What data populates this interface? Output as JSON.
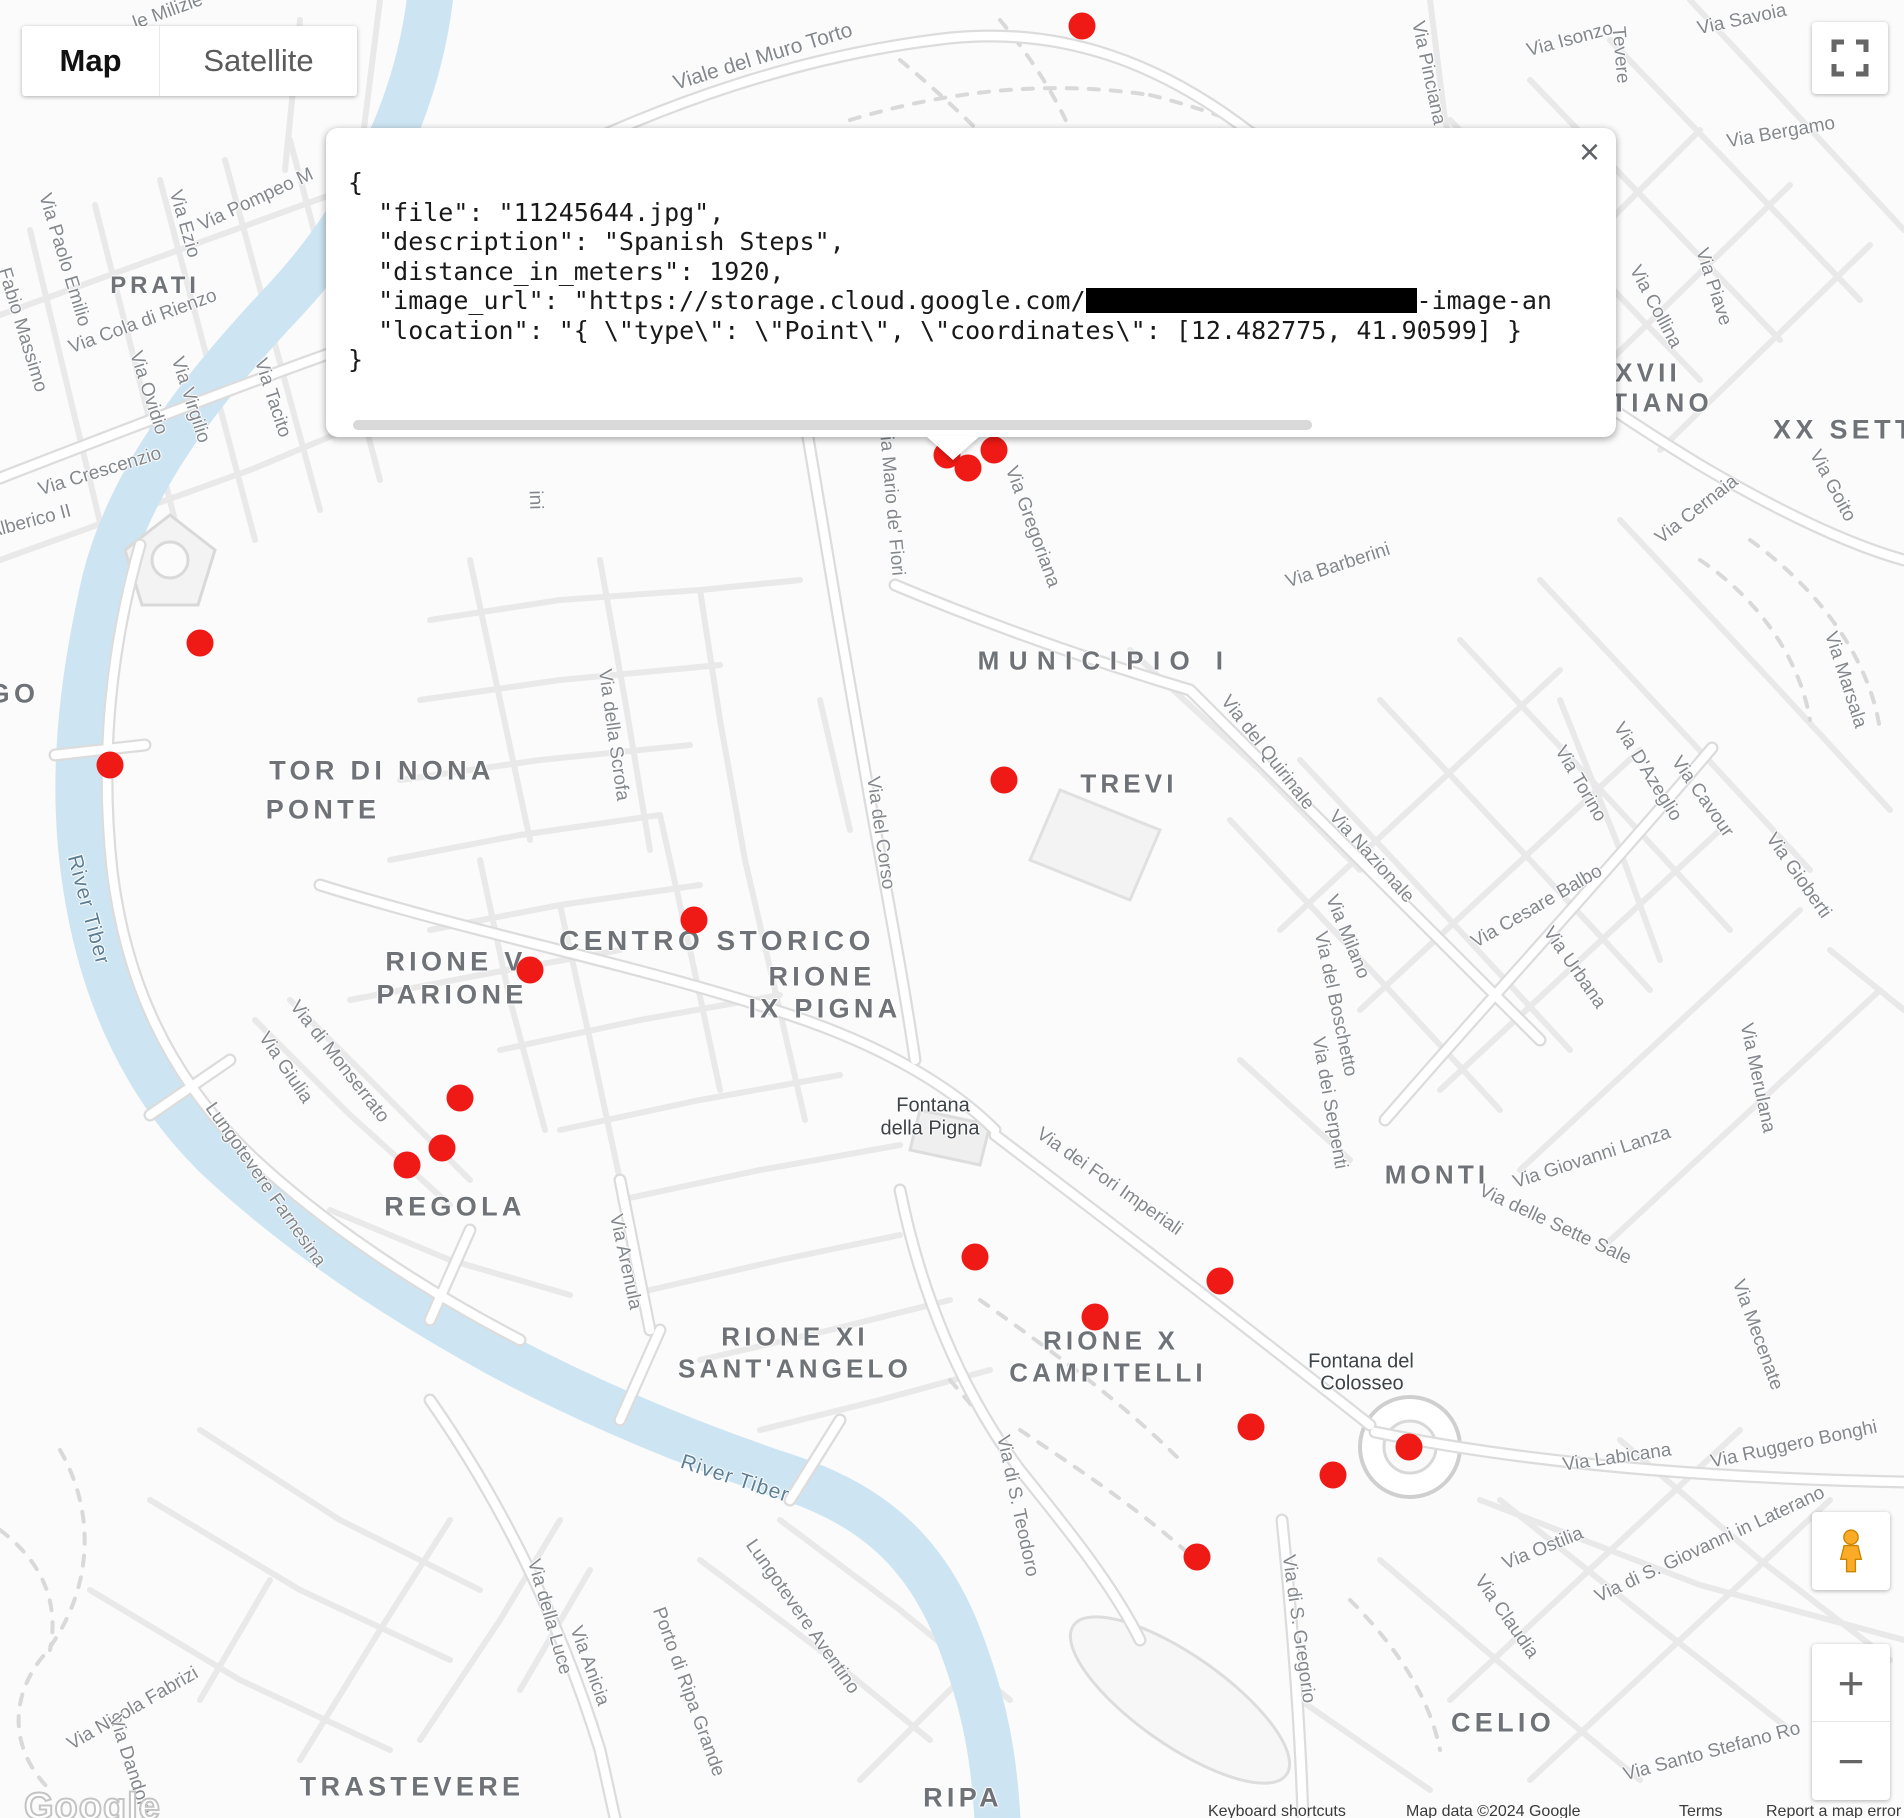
{
  "map_type_control": {
    "map": "Map",
    "satellite": "Satellite"
  },
  "info_window": {
    "close": "×",
    "lines": [
      {
        "text": "{"
      },
      {
        "text": "  \"file\": \"11245644.jpg\","
      },
      {
        "text": "  \"description\": \"Spanish Steps\","
      },
      {
        "text": "  \"distance_in_meters\": 1920,"
      },
      {
        "pre": "  \"image_url\": \"https://storage.cloud.google.com/",
        "redacted_width": 331,
        "post": "-image-an"
      },
      {
        "text": "  \"location\": \"{ \\\"type\\\": \\\"Point\\\", \\\"coordinates\\\": [12.482775, 41.90599] }"
      },
      {
        "text": "}"
      }
    ]
  },
  "marker_color": "#ef1a16",
  "markers": [
    [
      1082,
      26
    ],
    [
      947,
      455
    ],
    [
      968,
      468
    ],
    [
      994,
      450
    ],
    [
      200,
      643
    ],
    [
      110,
      765
    ],
    [
      1004,
      780
    ],
    [
      694,
      920
    ],
    [
      530,
      970
    ],
    [
      460,
      1098
    ],
    [
      442,
      1148
    ],
    [
      407,
      1165
    ],
    [
      975,
      1257
    ],
    [
      1220,
      1281
    ],
    [
      1095,
      1317
    ],
    [
      1251,
      1427
    ],
    [
      1409,
      1447
    ],
    [
      1333,
      1475
    ],
    [
      1197,
      1557
    ]
  ],
  "labels": {
    "area": [
      {
        "t": "PRATI",
        "x": 155,
        "y": 286,
        "s": 24
      },
      {
        "t": "GO",
        "x": 14,
        "y": 694
      },
      {
        "t": "TOR DI NONA",
        "x": 382,
        "y": 771
      },
      {
        "t": "PONTE",
        "x": 323,
        "y": 810
      },
      {
        "t": "MUNICIPIO I",
        "x": 1105,
        "y": 661,
        "s": 26,
        "ls": 0.36
      },
      {
        "t": "TREVI",
        "x": 1129,
        "y": 784,
        "s": 26
      },
      {
        "t": "CENTRO STORICO",
        "x": 717,
        "y": 941,
        "s": 28
      },
      {
        "t": "RIONE V",
        "x": 456,
        "y": 962
      },
      {
        "t": "PARIONE",
        "x": 452,
        "y": 995
      },
      {
        "t": "RIONE",
        "x": 822,
        "y": 977
      },
      {
        "t": "IX PIGNA",
        "x": 825,
        "y": 1009
      },
      {
        "t": "REGOLA",
        "x": 455,
        "y": 1207
      },
      {
        "t": "MONTI",
        "x": 1437,
        "y": 1175,
        "s": 26
      },
      {
        "t": "RIONE XI",
        "x": 795,
        "y": 1337,
        "s": 26
      },
      {
        "t": "SANT'ANGELO",
        "x": 795,
        "y": 1369,
        "s": 26
      },
      {
        "t": "RIONE X",
        "x": 1111,
        "y": 1341,
        "s": 26
      },
      {
        "t": "CAMPITELLI",
        "x": 1108,
        "y": 1373,
        "s": 26
      },
      {
        "t": "CELIO",
        "x": 1503,
        "y": 1723
      },
      {
        "t": "TRASTEVERE",
        "x": 412,
        "y": 1787
      },
      {
        "t": "RIPA",
        "x": 963,
        "y": 1798
      },
      {
        "t": "XVII",
        "x": 1648,
        "y": 373,
        "s": 26
      },
      {
        "t": "TIANO",
        "x": 1662,
        "y": 403,
        "s": 26
      },
      {
        "t": "XX SETTEMBRE",
        "x": 1773,
        "y": 430,
        "anchor": "left"
      }
    ],
    "street": [
      {
        "t": "le Milizie",
        "x": 168,
        "y": 12,
        "r": -20
      },
      {
        "t": "Viale del Muro Torto",
        "x": 763,
        "y": 57,
        "r": -17,
        "s": 21
      },
      {
        "t": "Via Pinciana",
        "x": 1428,
        "y": 73,
        "r": 78
      },
      {
        "t": "Via Isonzo",
        "x": 1570,
        "y": 40,
        "r": -15
      },
      {
        "t": "Tevere",
        "x": 1620,
        "y": 55,
        "r": 85
      },
      {
        "t": "Via Savoia",
        "x": 1742,
        "y": 20,
        "r": -12
      },
      {
        "t": "Via Bergamo",
        "x": 1781,
        "y": 133,
        "r": -10
      },
      {
        "t": "Via Piave",
        "x": 1713,
        "y": 287,
        "r": 72
      },
      {
        "t": "Via Collina",
        "x": 1655,
        "y": 307,
        "r": 62
      },
      {
        "t": "Via Goito",
        "x": 1832,
        "y": 486,
        "r": 62
      },
      {
        "t": "Via Cernaia",
        "x": 1697,
        "y": 510,
        "r": -38
      },
      {
        "t": "Via Marsala",
        "x": 1845,
        "y": 680,
        "r": 72
      },
      {
        "t": "Via Pompeo M",
        "x": 256,
        "y": 200,
        "r": -25
      },
      {
        "t": "Via Ezio",
        "x": 184,
        "y": 224,
        "r": 74
      },
      {
        "t": "Via Paolo Emilio",
        "x": 64,
        "y": 260,
        "r": 73
      },
      {
        "t": "Fabio Massimo",
        "x": 22,
        "y": 330,
        "r": 73
      },
      {
        "t": "Via Cola di Rienzo",
        "x": 143,
        "y": 322,
        "r": -20
      },
      {
        "t": "Via Ovidio",
        "x": 148,
        "y": 393,
        "r": 72
      },
      {
        "t": "Via Virgilio",
        "x": 190,
        "y": 400,
        "r": 72
      },
      {
        "t": "Via Tacito",
        "x": 272,
        "y": 398,
        "r": 72
      },
      {
        "t": "Via Crescenzio",
        "x": 100,
        "y": 472,
        "r": -17
      },
      {
        "t": "Alberico II",
        "x": 30,
        "y": 522,
        "r": -15
      },
      {
        "t": "ini",
        "x": 535,
        "y": 500,
        "r": 88
      },
      {
        "t": "Via della Scrofa",
        "x": 613,
        "y": 735,
        "r": 82
      },
      {
        "t": "Via del Corso",
        "x": 880,
        "y": 833,
        "r": 82
      },
      {
        "t": "Via Mario de' Fiori",
        "x": 891,
        "y": 500,
        "r": 85
      },
      {
        "t": "Via Gregoriana",
        "x": 1032,
        "y": 527,
        "r": 70
      },
      {
        "t": "Via Barberini",
        "x": 1338,
        "y": 566,
        "r": -18
      },
      {
        "t": "Via del Quirinale",
        "x": 1267,
        "y": 753,
        "r": 52
      },
      {
        "t": "Via Nazionale",
        "x": 1371,
        "y": 857,
        "r": 48
      },
      {
        "t": "Via Milano",
        "x": 1347,
        "y": 937,
        "r": 68
      },
      {
        "t": "Via del Boschetto",
        "x": 1335,
        "y": 1004,
        "r": 78
      },
      {
        "t": "Via dei Serpenti",
        "x": 1329,
        "y": 1103,
        "r": 80
      },
      {
        "t": "Via Torino",
        "x": 1580,
        "y": 784,
        "r": 60
      },
      {
        "t": "Via D'Azeglio",
        "x": 1647,
        "y": 772,
        "r": 58
      },
      {
        "t": "Via Cavour",
        "x": 1702,
        "y": 797,
        "r": 55
      },
      {
        "t": "Via Gioberti",
        "x": 1798,
        "y": 876,
        "r": 55
      },
      {
        "t": "Via Cesare Balbo",
        "x": 1537,
        "y": 907,
        "r": -30
      },
      {
        "t": "Via Urbana",
        "x": 1574,
        "y": 968,
        "r": 55
      },
      {
        "t": "Via Giovanni Lanza",
        "x": 1592,
        "y": 1158,
        "r": -18
      },
      {
        "t": "Via delle Sette Sale",
        "x": 1555,
        "y": 1225,
        "r": 25
      },
      {
        "t": "Via Merulana",
        "x": 1757,
        "y": 1078,
        "r": 78
      },
      {
        "t": "Via Mecenate",
        "x": 1757,
        "y": 1335,
        "r": 70
      },
      {
        "t": "Via Ruggero Bonghi",
        "x": 1794,
        "y": 1445,
        "r": -12
      },
      {
        "t": "Via Labicana",
        "x": 1617,
        "y": 1458,
        "r": -8
      },
      {
        "t": "Via di S. Giovanni in Laterano",
        "x": 1710,
        "y": 1545,
        "r": -25
      },
      {
        "t": "Via Ostilia",
        "x": 1543,
        "y": 1549,
        "r": -22
      },
      {
        "t": "Via Claudia",
        "x": 1506,
        "y": 1617,
        "r": 55
      },
      {
        "t": "Via Santo Stefano Ro",
        "x": 1712,
        "y": 1752,
        "r": -15
      },
      {
        "t": "Via di S. Gregorio",
        "x": 1298,
        "y": 1629,
        "r": 82
      },
      {
        "t": "Via di S. Teodoro",
        "x": 1017,
        "y": 1506,
        "r": 78
      },
      {
        "t": "Via dei Fori Imperiali",
        "x": 1109,
        "y": 1182,
        "r": 35
      },
      {
        "t": "Via Arenula",
        "x": 625,
        "y": 1262,
        "r": 78
      },
      {
        "t": "Via di Monserrato",
        "x": 339,
        "y": 1062,
        "r": 52
      },
      {
        "t": "Via Giulia",
        "x": 285,
        "y": 1068,
        "r": 56
      },
      {
        "t": "Lungotevere Farnesina",
        "x": 265,
        "y": 1185,
        "r": 55
      },
      {
        "t": "Via della Luce",
        "x": 549,
        "y": 1617,
        "r": 74
      },
      {
        "t": "Via Anicia",
        "x": 589,
        "y": 1666,
        "r": 70
      },
      {
        "t": "Via Nicola Fabrizi",
        "x": 133,
        "y": 1709,
        "r": -30
      },
      {
        "t": "Via Dandolo",
        "x": 130,
        "y": 1765,
        "r": 72
      },
      {
        "t": "Porto di Ripa Grande",
        "x": 688,
        "y": 1692,
        "r": 70
      },
      {
        "t": "Lungotevere Aventino",
        "x": 802,
        "y": 1617,
        "r": 55
      }
    ],
    "poi": [
      {
        "t": "Fontana",
        "x": 933,
        "y": 1106
      },
      {
        "t": "della Pigna",
        "x": 930,
        "y": 1129
      },
      {
        "t": "Fontana del",
        "x": 1361,
        "y": 1362
      },
      {
        "t": "Colosseo",
        "x": 1362,
        "y": 1384
      }
    ],
    "water": [
      {
        "t": "River Tiber",
        "x": 88,
        "y": 910,
        "r": 75
      },
      {
        "t": "River Tiber",
        "x": 735,
        "y": 1479,
        "r": 18
      }
    ]
  },
  "zoom_control": {
    "zoom_in": "+",
    "zoom_out": "−"
  },
  "attribution": {
    "keyboard_shortcuts": "Keyboard shortcuts",
    "map_data": "Map data ©2024 Google",
    "terms": "Terms",
    "report": "Report a map error"
  },
  "logo": "Google"
}
